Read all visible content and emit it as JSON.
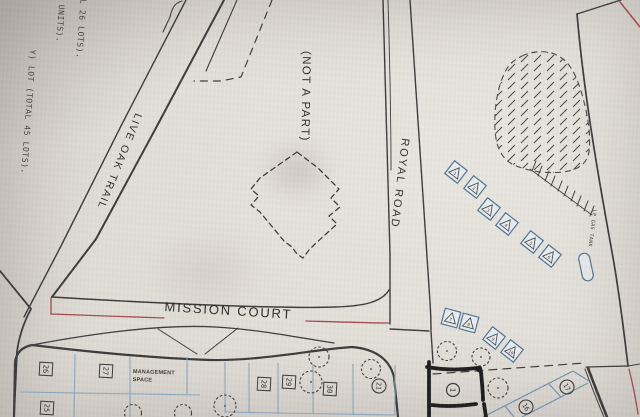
{
  "streets": {
    "live_oak_trail": "LIVE OAK TRAIL",
    "royal_road": "ROYAL ROAD",
    "mission_court": "MISSION COURT"
  },
  "areas": {
    "not_a_part": "(NOT A PART)",
    "management_space": "MANAGEMENT SPACE"
  },
  "features": {
    "lp_gas_tank": "LP GAS TANK"
  },
  "margin_notes": [
    "AL 26 LOTS).",
    "UNITS).",
    "Y) LOT (TOTAL 45 LOTS)."
  ],
  "lot_squares": [
    "26",
    "27",
    "25",
    "28",
    "29",
    "30"
  ],
  "lot_circles": [
    "21",
    "1",
    "16",
    "17"
  ],
  "site_markers": [
    "1",
    "2",
    "3",
    "4",
    "5",
    "6",
    "7",
    "8",
    "9",
    "10"
  ],
  "colors": {
    "paper": "#dedad4",
    "ink": "#3a3a3a",
    "blue": "#4d7394",
    "blue_light": "#8aa7c0",
    "blue_grid": "#6d93b0",
    "red": "#a4494d",
    "marker_ink": "#1b1b1b"
  }
}
